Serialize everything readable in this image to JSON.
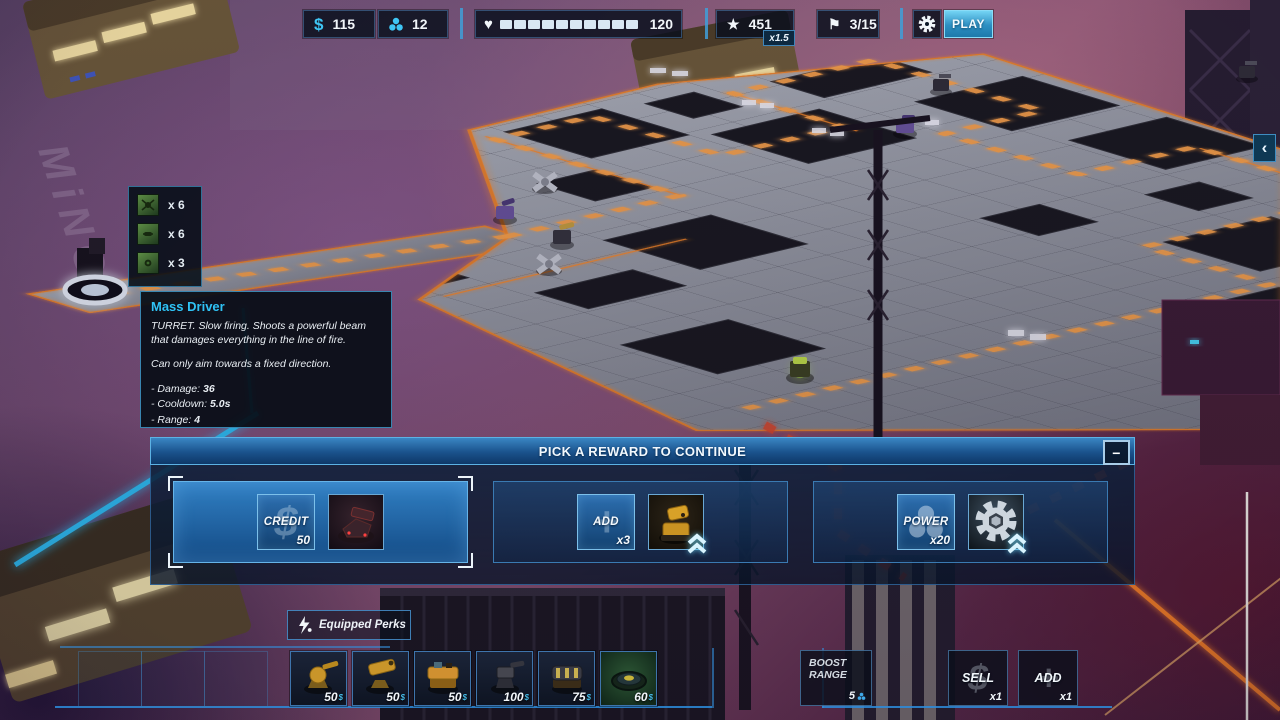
{
  "hud": {
    "credits": "115",
    "power": "12",
    "health": "120",
    "score": "451",
    "score_multiplier": "x1.5",
    "waves": "3/15",
    "play_label": "PLAY",
    "currency_symbol": "$",
    "icons": {
      "heart": "♥",
      "star": "★",
      "flag": "⚑"
    }
  },
  "enemy_preview": {
    "rows": [
      {
        "count": "x 6"
      },
      {
        "count": "x 6"
      },
      {
        "count": "x 3"
      }
    ]
  },
  "tooltip": {
    "title": "Mass Driver",
    "description_1": "TURRET.  Slow firing. Shoots a powerful beam that damages everything in the line of fire.",
    "description_2": "Can only aim towards a fixed direction.",
    "stats": [
      {
        "label": "- Damage:",
        "value": "36"
      },
      {
        "label": "- Cooldown:",
        "value": "5.0s"
      },
      {
        "label": "- Range:",
        "value": "4"
      }
    ]
  },
  "reward_panel": {
    "title": "PICK A REWARD TO CONTINUE",
    "minimize": "−",
    "cards": [
      {
        "label": "CREDIT",
        "amount": "50"
      },
      {
        "label": "ADD",
        "amount": "x3"
      },
      {
        "label": "POWER",
        "amount": "x20"
      }
    ]
  },
  "bottom_bar": {
    "equipped_perks": "Equipped Perks",
    "currency": "$",
    "shop_items": [
      {
        "price": "50"
      },
      {
        "price": "50"
      },
      {
        "price": "50"
      },
      {
        "price": "100"
      },
      {
        "price": "75"
      },
      {
        "price": "60"
      }
    ],
    "boost_range": {
      "line1": "BOOST",
      "line2": "RANGE",
      "value": "5"
    },
    "sell": {
      "label": "SELL",
      "count": "x1"
    },
    "add": {
      "label": "ADD",
      "count": "x1"
    }
  },
  "side": {
    "collapse": "‹"
  },
  "map": {
    "sign": "MiNG"
  },
  "colors": {
    "accent": "#3fc6f5",
    "path_orange": "#ff9a3c",
    "alert_red": "#e04a2a"
  }
}
